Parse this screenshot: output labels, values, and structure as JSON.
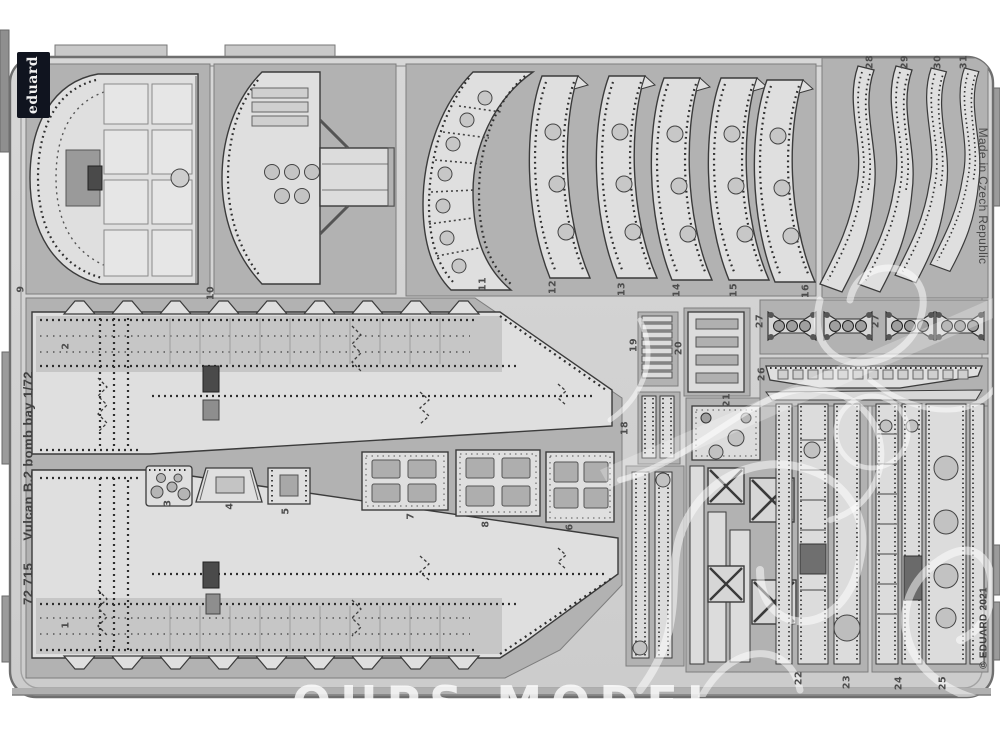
{
  "product": {
    "brand_logo": "eduard",
    "catalog_number": "72 715",
    "title": "Vulcan B.2 bomb bay 1/72",
    "made_in": "Made in Czech Republic",
    "copyright": "© EDUARD 2021"
  },
  "watermark": {
    "shop_text": "OUPS MODEL"
  },
  "part_labels": [
    "9",
    "10",
    "2",
    "1",
    "3",
    "4",
    "5",
    "7",
    "8",
    "6",
    "11",
    "12",
    "13",
    "14",
    "15",
    "16",
    "18",
    "19",
    "20",
    "21",
    "22",
    "23",
    "24",
    "25",
    "26",
    "27",
    "27",
    "28",
    "29",
    "30",
    "31"
  ],
  "colors": {
    "background": "#ffffff",
    "fret_base": "#d3d3d3",
    "etched_backdrop": "#b2b2b2",
    "part_surface": "#dfdfdf",
    "outline": "#3b3b3b",
    "logo_background": "#10141f",
    "watermark_white": "#ffffff"
  }
}
